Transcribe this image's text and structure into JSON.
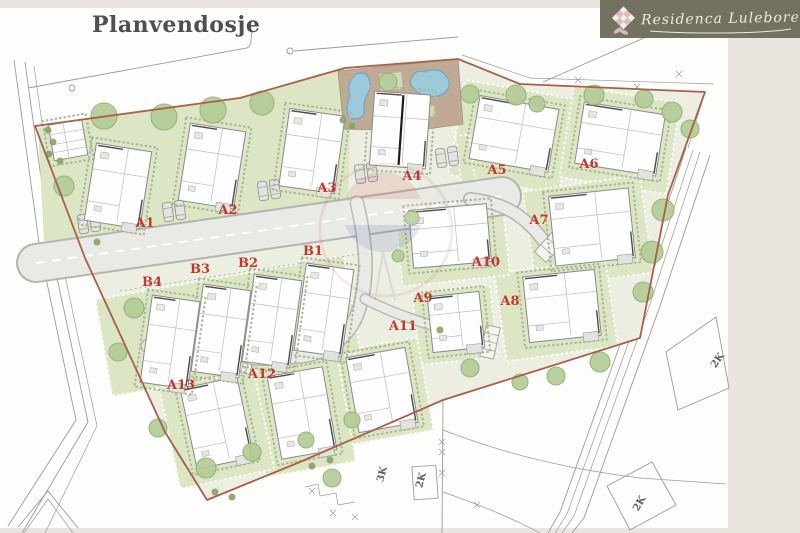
{
  "header": {
    "title": "Planvendosje"
  },
  "logo": {
    "name": "Residenca Lulebore",
    "icon": "lattice-flower",
    "bg_color": "#73715f",
    "text_color": "#f3e9dd"
  },
  "colors": {
    "paper": "#fdfdfb",
    "margin_beige": "#eae5df",
    "site_base": "#edeee2",
    "lawn": "#dce6c4",
    "tree": "#b4cd97",
    "tree_stroke": "#93b078",
    "bush": "#87a168",
    "road": "#e9e9e5",
    "road_edge": "#b4b4af",
    "terrace_tan": "#c0aa96",
    "pool_blue": "#9ec9da",
    "pool_stroke": "#6fa7bf",
    "boundary": "#a8604a",
    "label_red": "#c2382e",
    "survey_gray": "#9b9b98",
    "house_fill": "#fdfdfd",
    "house_stroke": "#8a8a8a",
    "pave_dot": "#aab795",
    "parcel_label_gray": "#5f5f5d"
  },
  "buildings": [
    {
      "id": "A1",
      "label": "A1",
      "label_pos": {
        "x": 145,
        "y": 227
      },
      "house": {
        "x": 118,
        "y": 186,
        "w": 56,
        "h": 78,
        "rot": 9
      }
    },
    {
      "id": "A2",
      "label": "A2",
      "label_pos": {
        "x": 228,
        "y": 214
      },
      "house": {
        "x": 212,
        "y": 166,
        "w": 56,
        "h": 78,
        "rot": 9
      }
    },
    {
      "id": "A3",
      "label": "A3",
      "label_pos": {
        "x": 327,
        "y": 192
      },
      "house": {
        "x": 312,
        "y": 151,
        "w": 56,
        "h": 78,
        "rot": 8
      }
    },
    {
      "id": "A4",
      "label": "A4",
      "label_pos": {
        "x": 412,
        "y": 180
      },
      "house": {
        "x": 400,
        "y": 130,
        "w": 56,
        "h": 74,
        "rot": 4,
        "duplex": true
      }
    },
    {
      "id": "A5",
      "label": "A5",
      "label_pos": {
        "x": 497,
        "y": 174
      },
      "house": {
        "x": 514,
        "y": 134,
        "w": 80,
        "h": 64,
        "rot": 10
      }
    },
    {
      "id": "A6",
      "label": "A6",
      "label_pos": {
        "x": 589,
        "y": 168
      },
      "house": {
        "x": 620,
        "y": 139,
        "w": 82,
        "h": 62,
        "rot": 9
      }
    },
    {
      "id": "A7",
      "label": "A7",
      "label_pos": {
        "x": 539,
        "y": 224
      },
      "house": {
        "x": 592,
        "y": 227,
        "w": 80,
        "h": 70,
        "rot": -6
      }
    },
    {
      "id": "A8",
      "label": "A8",
      "label_pos": {
        "x": 510,
        "y": 305
      },
      "house": {
        "x": 562,
        "y": 306,
        "w": 72,
        "h": 66,
        "rot": -6
      }
    },
    {
      "id": "A9",
      "label": "A9",
      "label_pos": {
        "x": 423,
        "y": 302
      },
      "house": {
        "x": 456,
        "y": 322,
        "w": 52,
        "h": 56,
        "rot": -6
      }
    },
    {
      "id": "A10",
      "label": "A10",
      "label_pos": {
        "x": 486,
        "y": 266
      },
      "house": {
        "x": 450,
        "y": 236,
        "w": 78,
        "h": 58,
        "rot": -5
      }
    },
    {
      "id": "A11",
      "label": "A11",
      "label_pos": {
        "x": 403,
        "y": 330
      },
      "house": {
        "x": 382,
        "y": 390,
        "w": 60,
        "h": 76,
        "rot": -10
      }
    },
    {
      "id": "A12",
      "label": "A12",
      "label_pos": {
        "x": 262,
        "y": 378
      },
      "house": {
        "x": 302,
        "y": 413,
        "w": 56,
        "h": 84,
        "rot": -10
      }
    },
    {
      "id": "A13",
      "label": "A13",
      "label_pos": {
        "x": 181,
        "y": 389
      },
      "house": {
        "x": 217,
        "y": 423,
        "w": 58,
        "h": 82,
        "rot": -12
      }
    },
    {
      "id": "B1",
      "label": "B1",
      "label_pos": {
        "x": 313,
        "y": 255
      },
      "house": {
        "x": 324,
        "y": 310,
        "w": 48,
        "h": 88,
        "rot": 8
      }
    },
    {
      "id": "B2",
      "label": "B2",
      "label_pos": {
        "x": 248,
        "y": 267
      },
      "house": {
        "x": 272,
        "y": 321,
        "w": 48,
        "h": 88,
        "rot": 8
      }
    },
    {
      "id": "B3",
      "label": "B3",
      "label_pos": {
        "x": 200,
        "y": 273
      },
      "house": {
        "x": 221,
        "y": 331,
        "w": 48,
        "h": 88,
        "rot": 8
      }
    },
    {
      "id": "B4",
      "label": "B4",
      "label_pos": {
        "x": 152,
        "y": 286
      },
      "house": {
        "x": 170,
        "y": 342,
        "w": 48,
        "h": 88,
        "rot": 8
      }
    }
  ],
  "adjacent_parcels": [
    {
      "label": "3K",
      "x": 385,
      "y": 475,
      "rot": -75
    },
    {
      "label": "2K",
      "x": 424,
      "y": 481,
      "rot": -75
    },
    {
      "label": "2K",
      "x": 720,
      "y": 362,
      "rot": -55
    },
    {
      "label": "2K",
      "x": 642,
      "y": 505,
      "rot": -60
    }
  ]
}
